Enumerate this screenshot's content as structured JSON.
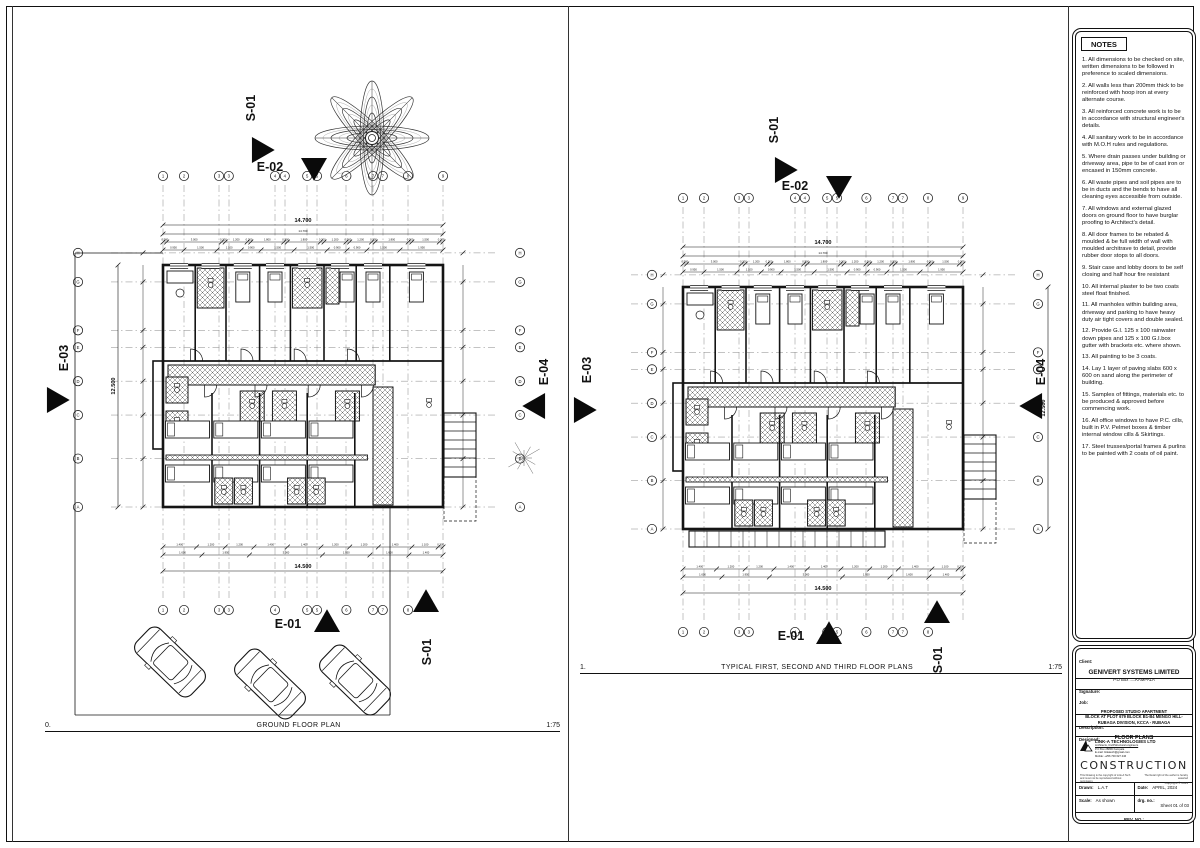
{
  "plans": [
    {
      "caption_num": "0.",
      "caption_title": "GROUND FLOOR PLAN",
      "caption_scale": "1:75",
      "dim_top": "14.700",
      "dim_side": "12.500",
      "dim_bottom": "14.500",
      "grid_top": [
        "1",
        "2",
        "3",
        "3",
        "4",
        "4",
        "5",
        "5",
        "6",
        "7",
        "7",
        "8",
        "9"
      ],
      "grid_bottom": [
        "1",
        "2",
        "3",
        "3",
        "4",
        "5",
        "5",
        "6",
        "7",
        "7",
        "8"
      ],
      "grid_left": [
        "H",
        "G",
        "F",
        "E",
        "D",
        "C",
        "B",
        "A"
      ],
      "grid_right": [
        "H",
        "G",
        "F",
        "E",
        "D",
        "C",
        "B",
        "A"
      ],
      "markers": {
        "s01t": "S-01",
        "e02": "E-02",
        "e03": "E-03",
        "e04": "E-04",
        "e01": "E-01",
        "s01b": "S-01"
      },
      "chain_top1": [
        "0.200",
        "3.000",
        "0.200",
        "1.200",
        "0.200",
        "1.800",
        "0.200",
        "1.800",
        "0.200",
        "1.200",
        "0.200",
        "1.200",
        "0.200",
        "1.800",
        "0.200",
        "1.500",
        "0.200"
      ],
      "chain_top2": [
        "0.950",
        "1.500",
        "1.100",
        "0.900",
        "1.500",
        "1.500",
        "0.900",
        "0.900",
        "1.500",
        "1.950"
      ],
      "chain_bottom1": [
        "1.400",
        "1.200",
        "1.200",
        "1.400",
        "1.400",
        "1.200",
        "1.200",
        "1.400",
        "1.100",
        "0.200"
      ],
      "chain_bottom2": [
        "1.600",
        "1.950",
        "3.000",
        "1.950",
        "1.600",
        "1.400"
      ]
    },
    {
      "caption_num": "1.",
      "caption_title": "TYPICAL FIRST, SECOND AND THIRD FLOOR PLANS",
      "caption_scale": "1:75",
      "dim_top": "14.700",
      "dim_side": "12.500",
      "dim_bottom": "14.500",
      "grid_top": [
        "1",
        "2",
        "3",
        "3",
        "4",
        "4",
        "5",
        "5",
        "6",
        "7",
        "7",
        "8",
        "9"
      ],
      "grid_bottom": [
        "1",
        "2",
        "3",
        "3",
        "4",
        "5",
        "5",
        "6",
        "7",
        "7",
        "8"
      ],
      "grid_left": [
        "H",
        "G",
        "F",
        "E",
        "D",
        "C",
        "B",
        "A"
      ],
      "grid_right": [
        "H",
        "G",
        "F",
        "E",
        "D",
        "C",
        "B",
        "A"
      ],
      "markers": {
        "s01t": "S-01",
        "e02": "E-02",
        "e03": "E-03",
        "e04": "E-04",
        "e01": "E-01",
        "s01b": "S-01"
      },
      "chain_top1": [
        "0.200",
        "3.000",
        "0.200",
        "1.200",
        "0.200",
        "1.800",
        "0.200",
        "1.800",
        "0.200",
        "1.200",
        "0.200",
        "1.200",
        "0.200",
        "1.800",
        "0.200",
        "1.500",
        "0.200"
      ],
      "chain_top2": [
        "0.950",
        "1.500",
        "1.100",
        "0.900",
        "1.500",
        "1.500",
        "0.900",
        "0.900",
        "1.500",
        "1.950"
      ],
      "chain_bottom1": [
        "1.400",
        "1.200",
        "1.200",
        "1.400",
        "1.400",
        "1.200",
        "1.200",
        "1.400",
        "1.100",
        "0.200"
      ],
      "chain_bottom2": [
        "1.600",
        "1.950",
        "3.000",
        "1.950",
        "1.600",
        "1.400"
      ]
    }
  ],
  "notes": {
    "title": "NOTES",
    "items": [
      "1. All dimensions to be checked on site, written dimensions to be followed in preference to scaled dimensions.",
      "2. All walls less than 200mm thick to be reinforced with hoop iron at every alternate course.",
      "3. All reinforced concrete work is to be in accordance with structural engineer's details.",
      "4. All sanitary work to be in accordance with M.O.H rules and regulations.",
      "5. Where drain passes under building or driveway area, pipe to be of cast iron or encased in 150mm concrete.",
      "6. All waste pipes and soil pipes are to be in ducts and the bends to have all cleaning eyes accessible from outside.",
      "7. All windows and external glazed doors on ground floor to have burglar proofing to Architect's detail.",
      "8. All door frames to be rebated & moulded & be full width of wall with moulded architrave to detail, provide rubber door stops to all doors.",
      "9. Stair case and lobby doors to be self closing and half hour fire resistant",
      "10. All internal plaster to be two coats steel float finished.",
      "11. All manholes within building area, driveway and parking to have heavy duty air tight covers and double sealed.",
      "12. Provide G.I. 125 x 100 rainwater down  pipes and 125 x 100 G.I.box gutter with brackets etc. where shown.",
      "13. All painting to be 3 coats.",
      "14. Lay 1 layer of paving slabs 600 x 600 on sand along the perimeter of building.",
      "15. Samples of fittings, materials etc. to be produced & approved before commencing work.",
      "16. All office windows to have P.C. cills, built in P.V. Pelmet boxes & timber internal window cills & Skirtings.",
      "17. Steel trusses/portal frames & purlins to be painted with 2 coats of oil paint."
    ]
  },
  "title_block": {
    "client_label": "Client:",
    "client_name": "GENIVERT SYSTEMS LIMITED",
    "client_addr": "P.O Box .....KAMPALA",
    "signature_label": "Signature:",
    "job_label": "Job:",
    "job_lines": [
      "PROPOSED STUDIO APARTMENT",
      "BLOCK AT PLOT 679 BLOCK B1-B4 MENGO HILL-",
      "RUBAGA DIVISION, KCCA - RUBAGA"
    ],
    "description_label": "Description:",
    "description_value": "FLOOR PLANS",
    "designed_label": "Designed:",
    "firm_name": "LINK-A TECHNOLOGIES LTD",
    "firm_lines": [
      "Architects, Civil/Structural engineers",
      "P.O Box 28896 Kampala",
      "E-mail: linkatech@gmail.com",
      "Mobile: +256 700 627 446"
    ],
    "construction": "CONSTRUCTION",
    "copy_left": "This Drawing is the copyright of Link-A Tech and must not be reproduced without permission.",
    "copy_right": "The literal right of the author is hereby asserted",
    "copyright_line": "Copyright © 2024",
    "drawn_label": "Drawn:",
    "drawn_value": "L.A.T",
    "date_label": "Date:",
    "date_value": "APRIL, 2024",
    "scale_label": "Scale:",
    "scale_value": "As shown",
    "drg_label": "drg. no.:",
    "drg_value": "Sheet 01 of 03",
    "rev_label": "REV. NO.:"
  }
}
